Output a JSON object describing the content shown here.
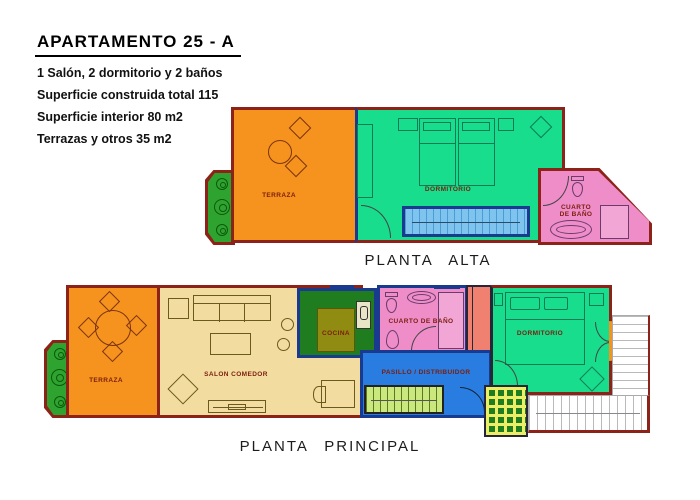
{
  "header": {
    "title": "APARTAMENTO 25 - A",
    "specs": [
      "1 Salón, 2 dormitorio y 2 baños",
      "Superficie construida total 115",
      "Superficie interior 80 m2",
      "Terrazas y otros 35 m2"
    ]
  },
  "planta_alta": {
    "caption": "PLANTA ALTA",
    "rooms": {
      "terraza": "TERRAZA",
      "dormitorio": "DORMITORIO",
      "bano_line1": "CUARTO",
      "bano_line2": "DE BAÑO"
    }
  },
  "planta_principal": {
    "caption": "PLANTA PRINCIPAL",
    "rooms": {
      "terraza": "TERRAZA",
      "salon": "SALON COMEDOR",
      "cocina": "COCINA",
      "bano": "CUARTO DE BAÑO",
      "pasillo": "PASILLO / DISTRIBUIDOR",
      "dormitorio": "DORMITORIO",
      "balcon": "BALCON"
    }
  },
  "colors": {
    "wall_red": "#8D2318",
    "partition_navy": "#1A3A8F",
    "terraza_orange": "#F6921E",
    "dormitorio_green": "#17DD8D",
    "bath_pink": "#EF8DC9",
    "salon_tan": "#F3DCA0",
    "cocina_olive": "#908C12",
    "counter_green": "#1F7D1F",
    "planter_green": "#2FA32F",
    "pasillo_blue": "#2A7DE0",
    "stairs_light_blue": "#7EC4EE",
    "stairs_yellow_green": "#CBE87E",
    "patio_yellow": "#EDED66",
    "wardrobe_salmon": "#F08070"
  }
}
